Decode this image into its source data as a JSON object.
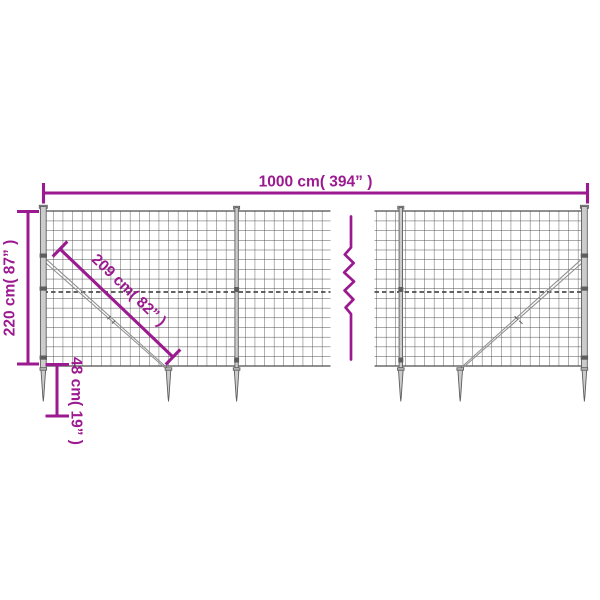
{
  "title": "Wire mesh fence with ground anchor spikes - dimension diagram",
  "labels": {
    "width": "1000 cm( 394” )",
    "height": "220 cm( 87” )",
    "diagonal": "209 cm( 82” )",
    "spike": "48 cm( 19” )"
  },
  "measurements": {
    "width_cm": 1000,
    "width_in": 394,
    "height_cm": 220,
    "height_in": 87,
    "diagonal_cm": 209,
    "diagonal_in": 82,
    "spike_cm": 48,
    "spike_in": 19
  },
  "colors": {
    "accent": "#9c1a90",
    "wire": "#4e4e4e",
    "steel_fill": "#cccccc",
    "steel_dark": "#5e5e5e",
    "brace": "#8f8f8f",
    "bg": "#ffffff"
  }
}
